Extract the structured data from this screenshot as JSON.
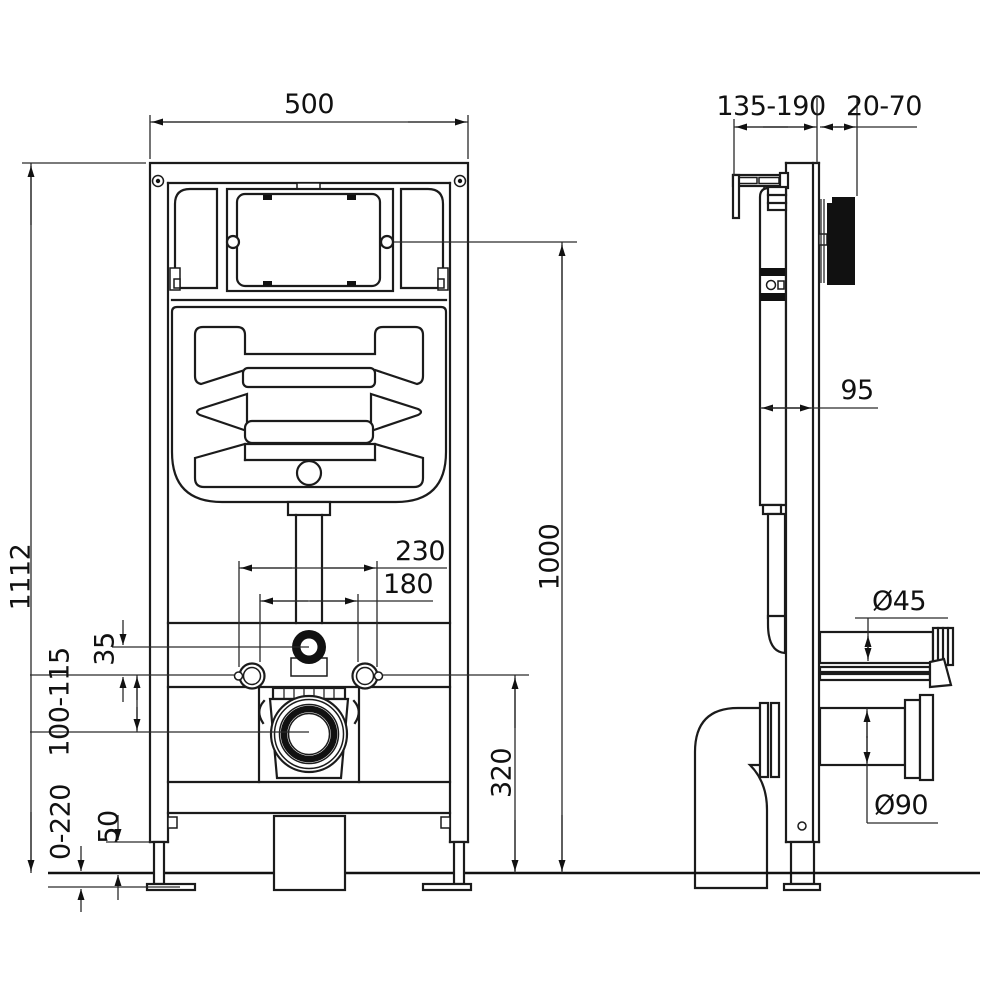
{
  "front_view": {
    "width_500": "500",
    "height_1112": "1112",
    "spacing_230": "230",
    "spacing_180": "180",
    "offset_35": "35",
    "range_100_115": "100-115",
    "range_0_220": "0-220",
    "foot_50": "50",
    "height_320": "320",
    "height_1000": "1000"
  },
  "side_view": {
    "range_135_190": "135-190",
    "range_20_70": "20-70",
    "depth_95": "95",
    "flush_pipe_dia": "Ø45",
    "drain_pipe_dia": "Ø90"
  }
}
